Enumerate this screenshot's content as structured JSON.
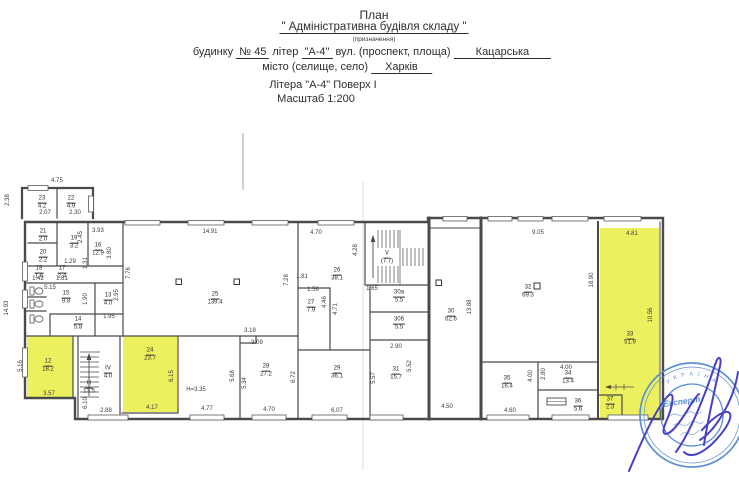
{
  "header": {
    "title": "План",
    "subtitle": "\" Адміністративна будівля складу \"",
    "note": "(призначення)",
    "l4_a": "будинку",
    "l4_no": "№ 45",
    "l4_b": "літер",
    "l4_lit": "\"А-4\"",
    "l4_c": "вул. (проспект, площа)",
    "l4_street": "Кацарська",
    "l5_a": "місто (селище, село)",
    "l5_city": "Харків",
    "l6": "Літера \"А-4\" Поверх I",
    "l7": "Масштаб 1:200"
  },
  "plan": {
    "height_note": "Н=3.35",
    "rooms": {
      "r12": {
        "n": "12",
        "a": "18.2"
      },
      "r13": {
        "n": "13",
        "a": "4.0"
      },
      "r14": {
        "n": "14",
        "a": "5.8"
      },
      "r15": {
        "n": "15",
        "a": "9.8"
      },
      "r16": {
        "n": "16",
        "a": "12.9"
      },
      "r17": {
        "n": "17",
        "a": "2.4"
      },
      "r18": {
        "n": "18",
        "a": "1.6"
      },
      "r19": {
        "n": "19",
        "a": "3.2"
      },
      "r20": {
        "n": "20",
        "a": "2.2"
      },
      "r21": {
        "n": "21",
        "a": "2.0"
      },
      "r22": {
        "n": "22",
        "a": "4.9"
      },
      "r23": {
        "n": "23",
        "a": "4.2"
      },
      "r24": {
        "n": "24",
        "a": "23.7"
      },
      "r25": {
        "n": "25",
        "a": "139.4"
      },
      "r26": {
        "n": "26",
        "a": "38.1"
      },
      "r27": {
        "n": "27",
        "a": "7.9"
      },
      "r28": {
        "n": "28",
        "a": "27.2"
      },
      "r29": {
        "n": "29",
        "a": "36.1"
      },
      "r30": {
        "n": "30",
        "a": "62.6"
      },
      "r30a": {
        "n": "30а",
        "a": "5.5"
      },
      "r30b": {
        "n": "30б",
        "a": "5.5"
      },
      "r31": {
        "n": "31",
        "a": "15.7"
      },
      "r32": {
        "n": "32",
        "a": "69.3"
      },
      "r33": {
        "n": "33",
        "a": "51.9"
      },
      "r34": {
        "n": "34",
        "a": "13.4"
      },
      "r35": {
        "n": "35",
        "a": "16.4"
      },
      "r36": {
        "n": "36",
        "a": "5.6"
      },
      "r37": {
        "n": "37",
        "a": "2.3"
      },
      "sIII": {
        "n": "III",
        "a": "13.5"
      },
      "sIV": {
        "n": "IV",
        "a": "4.0"
      },
      "sV": {
        "n": "V",
        "a": "(7.7)"
      }
    },
    "dims": {
      "d1": "4.75",
      "d2": "2.38",
      "d3": "2.07",
      "d4": "2.30",
      "d5": "2.45",
      "d6": "3.93",
      "d7": "3.80",
      "d8": "1.29",
      "d9": "1.31",
      "d10": "1.42",
      "d11": "1.81",
      "d12": "5.15",
      "d13": "1.90",
      "d14": "2.95",
      "d15": "1.95",
      "d16": "14.93",
      "d17": "14.91",
      "d18": "7.76",
      "d19": "5.16",
      "d20": "3.57",
      "d21": "6.10",
      "d22": "2.88",
      "d23": "6.15",
      "d24": "4.17",
      "d25": "Н=3.35",
      "d26": "4.77",
      "d27": "4.70",
      "d28": "7.28",
      "d29": "1.81",
      "d30": "1.56",
      "d31": "4.46",
      "d32": "4.71",
      "d33": "4.28",
      "d34": "1.65",
      "d35": "3.18",
      "d36": "3.09",
      "d37": "5.68",
      "d38": "5.34",
      "d39": "6.72",
      "d40": "4.70",
      "d41": "6.07",
      "d42": "2.90",
      "d43": "5.57",
      "d44": "5.52",
      "d45": "4.50",
      "d46": "13.88",
      "d47": "9.05",
      "d48": "4.00",
      "d49": "4.00",
      "d50": "2.80",
      "d51": "4.60",
      "d52": "18.90",
      "d53": "4.81",
      "d54": "10.56"
    }
  },
  "stamp": {
    "center_text": "Експерт",
    "ring_text": "· У К Р А Ї Н А ·",
    "ring_dots": "· · · · · · · · · · · · · · · · · · · · · · · ·"
  },
  "colors": {
    "highlight": "#edf05e",
    "stamp_blue": "#5b8fd2",
    "signature_blue": "#4840c4",
    "line": "#4a4a4a"
  }
}
